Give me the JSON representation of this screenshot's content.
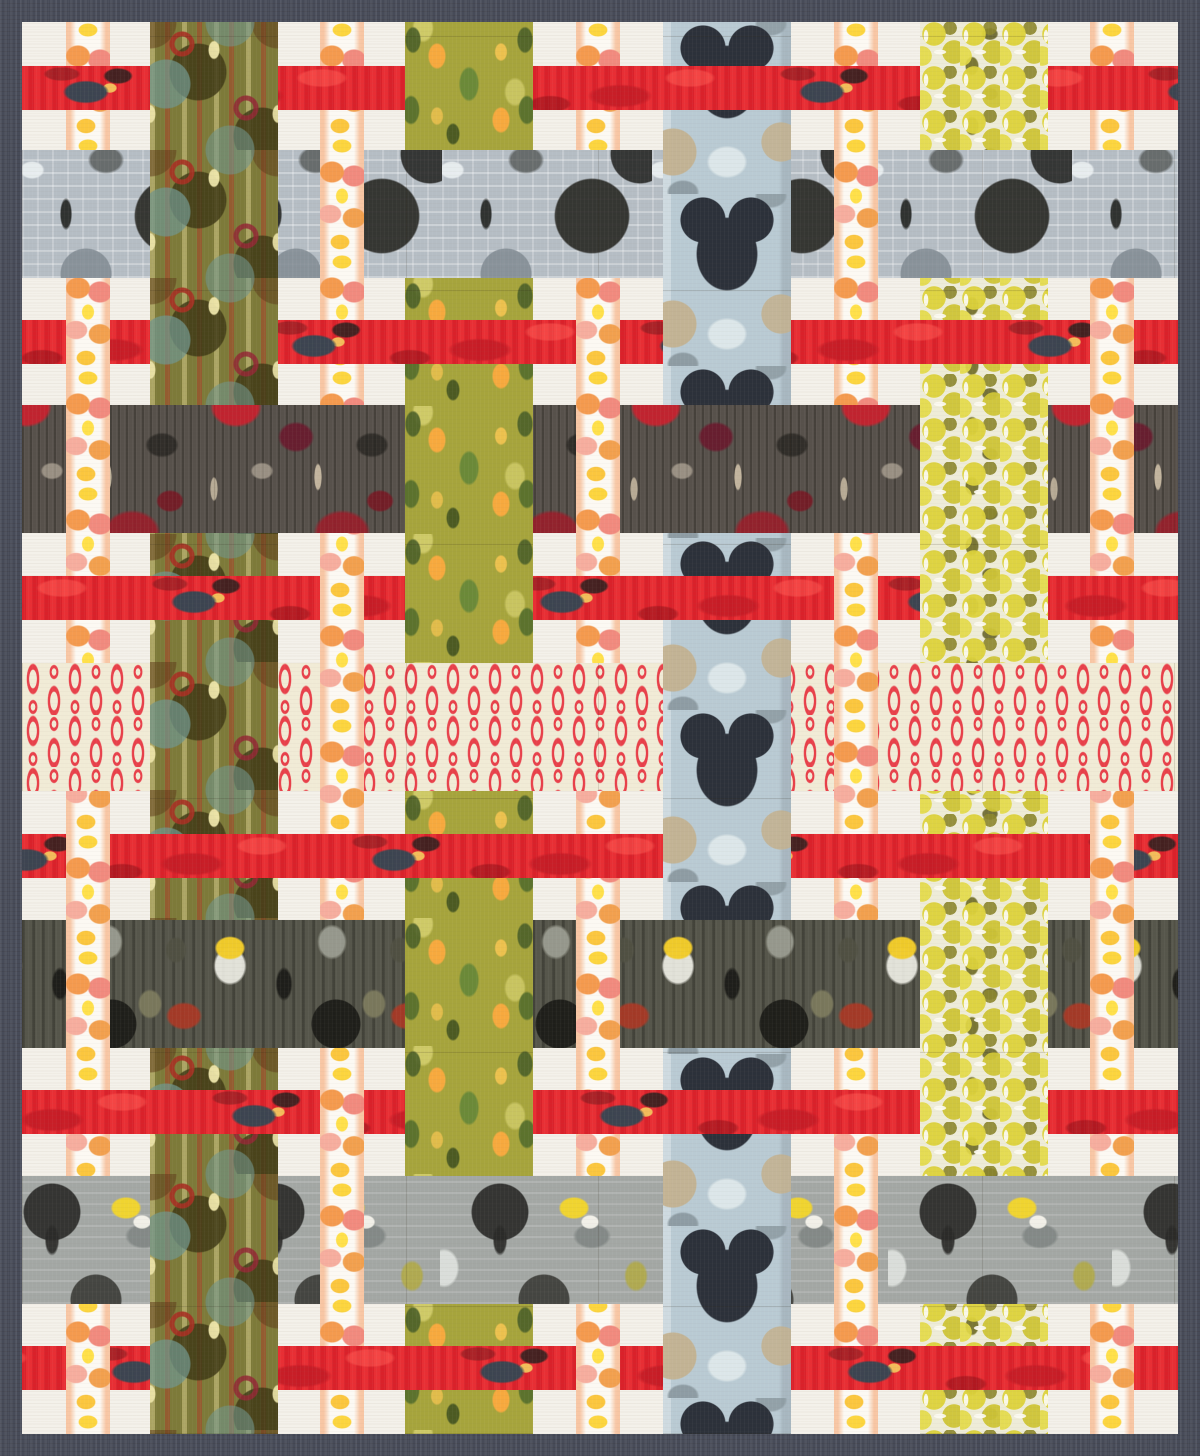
{
  "quilt": {
    "description": "Patchwork quilt mockup: woven plaid of printed fabric strips on a cream ground with dark slate binding",
    "canvas": {
      "width": 1200,
      "height": 1456
    },
    "frame": {
      "binding_color": "#474b58",
      "binding_width": 22,
      "background_color": "#f4f1ea",
      "content_width": 1156,
      "content_height": 1412
    },
    "fabrics": [
      {
        "id": "flame",
        "name": "flame watercolor blob stripe",
        "base": "#fcf9f3",
        "accents": [
          "#f49a4e",
          "#f18a7e",
          "#fcd53e",
          "#f6ad9e"
        ]
      },
      {
        "id": "red",
        "name": "painterly red band",
        "base": "#e5242e",
        "accents": [
          "#34464e",
          "#c41c26",
          "#f4c45c",
          "#961a22"
        ]
      },
      {
        "id": "olivemod",
        "name": "olive mod circles and hairpins",
        "base": "#7d7a39",
        "accents": [
          "#a63022",
          "#6f948a",
          "#403a16",
          "#eee6aa"
        ]
      },
      {
        "id": "leafy",
        "name": "chartreuse leaves with apricot diamonds",
        "base": "#a6a43c",
        "accents": [
          "#f7a93e",
          "#688838",
          "#4c6028",
          "#e4de7e"
        ]
      },
      {
        "id": "bluearch",
        "name": "blue-gray arches with navy clovers",
        "base": "#b9cad3",
        "accents": [
          "#2c313a",
          "#c3b291",
          "#8b979e",
          "#dee8ea"
        ]
      },
      {
        "id": "chartreuse",
        "name": "chartreuse matchstick circles",
        "base": "#eeecd8",
        "accents": [
          "#ddd23a",
          "#8c862c",
          "#5f5c1e",
          "#fcfaf0"
        ]
      },
      {
        "id": "grayarch",
        "name": "gray architectural arch print",
        "base": "#b5bdc4",
        "accents": [
          "#2a2a26",
          "#808a92",
          "#ebf0f2"
        ]
      },
      {
        "id": "maroon",
        "name": "maroon charcoal collage",
        "base": "#57514b",
        "accents": [
          "#c6222e",
          "#681c2e",
          "#c8baa2",
          "#242220"
        ]
      },
      {
        "id": "dash",
        "name": "red capsule dashes on cream",
        "base": "#f1ebd6",
        "accents": [
          "#e8404a"
        ]
      },
      {
        "id": "darkginkgo",
        "name": "dark olive collage with yellow ginkgo",
        "base": "#56564b",
        "accents": [
          "#f2cc2a",
          "#ac3824",
          "#1a1a16",
          "#9a9c90"
        ]
      },
      {
        "id": "graystar",
        "name": "gray helmet arches with yellow moths",
        "base": "#a3a7a4",
        "accents": [
          "#f4d62a",
          "#2a2a28",
          "#dee2de",
          "#b2aa3c"
        ]
      }
    ],
    "columns": [
      {
        "id": "c0",
        "x": 44,
        "w": 44,
        "fabric": "flame"
      },
      {
        "id": "c1",
        "x": 128,
        "w": 128,
        "fabric": "olivemod"
      },
      {
        "id": "c2",
        "x": 298,
        "w": 44,
        "fabric": "flame"
      },
      {
        "id": "c3",
        "x": 383,
        "w": 128,
        "fabric": "leafy"
      },
      {
        "id": "c4",
        "x": 554,
        "w": 44,
        "fabric": "flame"
      },
      {
        "id": "c5",
        "x": 641,
        "w": 128,
        "fabric": "bluearch"
      },
      {
        "id": "c6",
        "x": 812,
        "w": 44,
        "fabric": "flame"
      },
      {
        "id": "c7",
        "x": 898,
        "w": 128,
        "fabric": "chartreuse"
      },
      {
        "id": "c8",
        "x": 1068,
        "w": 44,
        "fabric": "flame"
      }
    ],
    "rows": [
      {
        "id": "r0",
        "y": 44,
        "h": 44,
        "fabric": "red",
        "phase": 0
      },
      {
        "id": "r1",
        "y": 128,
        "h": 128,
        "fabric": "grayarch",
        "phase": 0
      },
      {
        "id": "r2",
        "y": 298,
        "h": 44,
        "fabric": "red",
        "phase": 140
      },
      {
        "id": "r3",
        "y": 383,
        "h": 128,
        "fabric": "maroon",
        "phase": 40
      },
      {
        "id": "r4",
        "y": 554,
        "h": 44,
        "fabric": "red",
        "phase": 260
      },
      {
        "id": "r5",
        "y": 641,
        "h": 128,
        "fabric": "dash",
        "phase": 0
      },
      {
        "id": "r6",
        "y": 812,
        "h": 44,
        "fabric": "red",
        "phase": 60
      },
      {
        "id": "r7",
        "y": 898,
        "h": 128,
        "fabric": "darkginkgo",
        "phase": 80
      },
      {
        "id": "r8",
        "y": 1068,
        "h": 44,
        "fabric": "red",
        "phase": 200
      },
      {
        "id": "r9",
        "y": 1154,
        "h": 128,
        "fabric": "graystar",
        "phase": 30
      },
      {
        "id": "r10",
        "y": 1324,
        "h": 44,
        "fabric": "red",
        "phase": 320
      }
    ],
    "weave_legend": "one string per row, one char per column: C = vertical strip passes over the row, R = horizontal strip passes over the column",
    "weave": [
      "RCRCRRRCR",
      "RCCRRCCRR",
      "CCRRCCRRC",
      "CRRCCRRCC",
      "RRCCRRCCR",
      "RCCRRCCRR",
      "CRRRRCRRC",
      "CRRCCRRCC",
      "RRCCRRRCR",
      "RCCRRCCRR",
      "CCRRCCRRC"
    ]
  }
}
